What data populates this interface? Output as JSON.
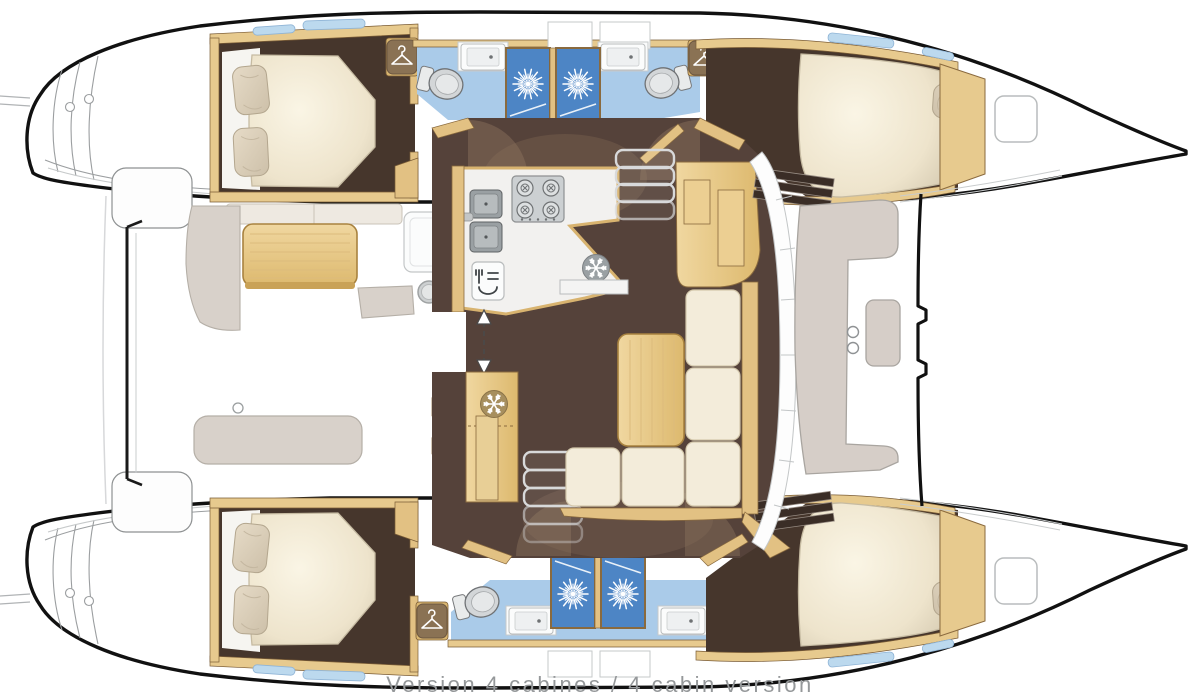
{
  "caption": {
    "text": "Version 4 cabines / 4 cabin version",
    "color": "#95989a"
  },
  "plan": {
    "vessel": "catamaran",
    "view": "top-down-floor-plan",
    "areas": [
      "aft-cockpit",
      "salon-galley",
      "forward-cockpit",
      "trampoline-foredeck",
      "port-aft-cabin",
      "port-forward-cabin",
      "starboard-aft-cabin",
      "starboard-forward-cabin",
      "port-bathroom",
      "starboard-bathroom",
      "transom-steps-port",
      "transom-steps-starboard"
    ],
    "fixtures": {
      "beds": 4,
      "showers": 4,
      "toilets": 4,
      "bathroom_sinks": 4,
      "galley_burners": 4,
      "wardrobes": 4,
      "companionway_stairs": 2
    }
  },
  "icons": {
    "shower": "starburst-icon",
    "refrigeration": "snowflake-icon",
    "wardrobe": "hanger-icon",
    "entry": "double-arrow-icon",
    "galley": [
      "stove-icon",
      "double-sink-icon",
      "oven-icon"
    ]
  },
  "colors": {
    "hull_outline": "#111111",
    "wood_light": "#eccf92",
    "wood_dark": "#a8823f",
    "cabin_floor": "#46362c",
    "salon_floor": "#55423a",
    "bathroom_floor": "#aacbe9",
    "shower_stall": "#4d85c5",
    "mattress": "#f3ecd9",
    "sofa": "#f3ecda",
    "cockpit_seat": "#d8d1ca",
    "caption_text": "#95989a"
  }
}
